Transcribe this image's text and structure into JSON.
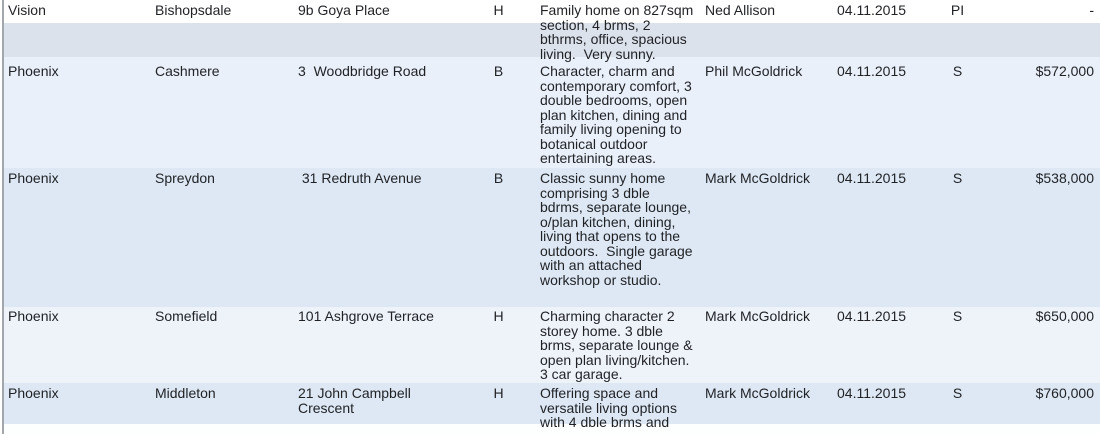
{
  "colors": {
    "row_white": "#ffffff",
    "row_gray_blue": "#dce2ec",
    "row_light_blue": "#e9f0fa",
    "row_blue": "#dde8f4",
    "row_faint_blue": "#eef3fa",
    "text": "#1f2125",
    "left_border": "#a3a7ad"
  },
  "table": {
    "rows": [
      {
        "office": "Vision",
        "suburb": "Bishopsdale",
        "address": "9b Goya Place",
        "type": "H",
        "description": "Family home on 827sqm\nsection, 4 brms, 2\nbthrms, office, spacious\nliving.  Very sunny.",
        "agent": "Ned Allison",
        "date": "04.11.2015",
        "status": "PI",
        "price": "-"
      },
      {
        "office": "Phoenix",
        "suburb": "Cashmere",
        "address": "3  Woodbridge Road",
        "type": "B",
        "description": "Character, charm and\ncontemporary comfort, 3\ndouble bedrooms, open\nplan kitchen, dining and\nfamily living opening to\nbotanical outdoor\nentertaining areas.",
        "agent": "Phil McGoldrick",
        "date": "04.11.2015",
        "status": "S",
        "price": "$572,000"
      },
      {
        "office": "Phoenix",
        "suburb": "Spreydon",
        "address": " 31 Redruth Avenue",
        "type": "B",
        "description": "Classic sunny home\ncomprising 3 dble\nbdrms, separate lounge,\no/plan kitchen, dining,\nliving that opens to the\noutdoors.  Single garage\nwith an attached\nworkshop or studio.",
        "agent": "Mark McGoldrick",
        "date": "04.11.2015",
        "status": "S",
        "price": "$538,000"
      },
      {
        "office": "Phoenix",
        "suburb": "Somefield",
        "address": "101 Ashgrove Terrace",
        "type": "H",
        "description": "Charming character 2\nstorey home. 3 dble\nbrms, separate lounge &\nopen plan living/kitchen.\n3 car garage.",
        "agent": "Mark McGoldrick",
        "date": "04.11.2015",
        "status": "S",
        "price": "$650,000"
      },
      {
        "office": "Phoenix",
        "suburb": "Middleton",
        "address": "21 John Campbell Crescent",
        "type": "H",
        "description": "Offering space and\nversatile living options\nwith 4 dble brms and",
        "agent": "Mark McGoldrick",
        "date": "04.11.2015",
        "status": "S",
        "price": "$760,000"
      }
    ]
  }
}
